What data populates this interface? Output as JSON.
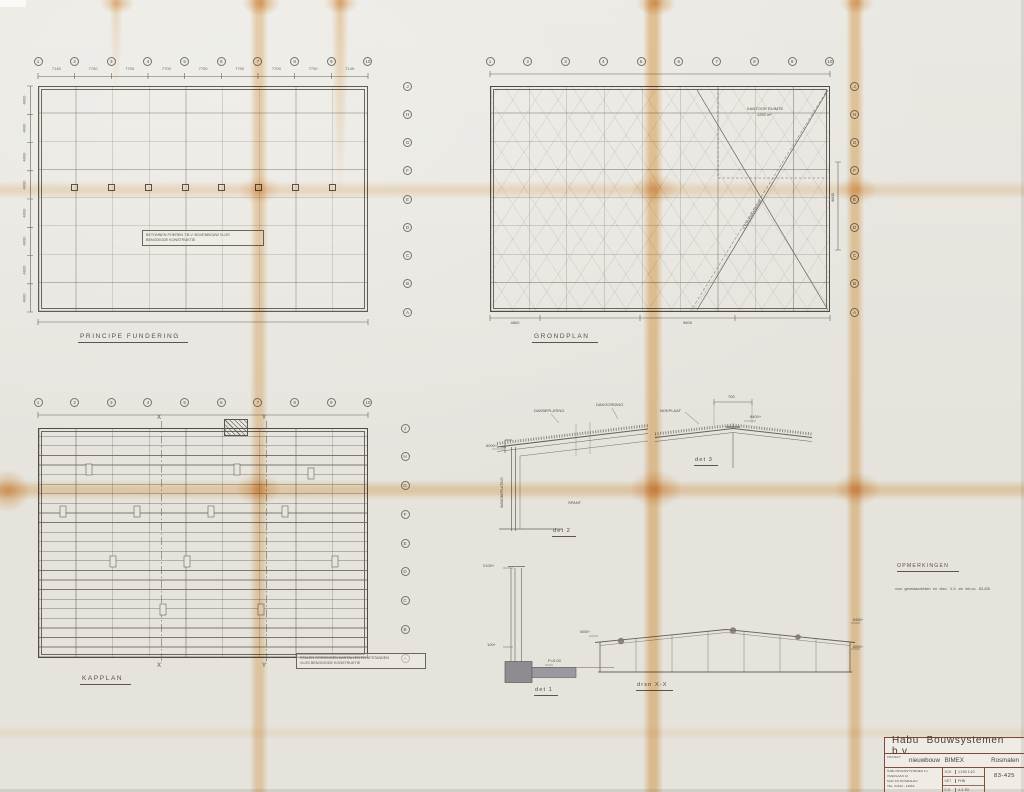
{
  "colors": {
    "paper": "#e7e5df",
    "line": "#66625b",
    "fold": "#ecba78",
    "titleblock_line": "#7c4c38"
  },
  "fundering": {
    "title": "PRINCIPE FUNDERING",
    "cols": [
      "1",
      "2",
      "3",
      "4",
      "5",
      "6",
      "7",
      "8",
      "9",
      "10"
    ],
    "rows": [
      "J",
      "H",
      "G",
      "F",
      "E",
      "D",
      "C",
      "B",
      "A"
    ],
    "top_dims": [
      "7145",
      "7700",
      "7700",
      "7700",
      "7700",
      "7700",
      "7700",
      "7700",
      "7145"
    ],
    "left_dims": [
      "4800",
      "4800",
      "4800",
      "4800",
      "4800",
      "4800",
      "4800",
      "4800"
    ],
    "note_line1": "BETONNEN POEREN T.B.V. BOVENBOUW VLGS",
    "note_line2": "BENODIGDE KONSTRUKTIE"
  },
  "grondplan": {
    "title": "GRONDPLAN",
    "cols": [
      "1",
      "2",
      "3",
      "4",
      "5",
      "6",
      "7",
      "8",
      "9",
      "10"
    ],
    "rows": [
      "J",
      "H",
      "G",
      "F",
      "E",
      "D",
      "C",
      "B",
      "A"
    ],
    "kantoor_line1": "KANTOOR RUIMTE",
    "kantoor_line2": "±250 m²",
    "kraan_label": "5 TON KRAANBAAN",
    "dim_right": "4800",
    "dim_bottom_left": "4800",
    "dim_bottom_mid": "9600"
  },
  "kapplan": {
    "title": "KAPPLAN",
    "cols": [
      "1",
      "2",
      "3",
      "4",
      "5",
      "6",
      "7",
      "8",
      "9",
      "10"
    ],
    "rows": [
      "J",
      "H",
      "G",
      "F",
      "E",
      "D",
      "C",
      "B",
      "A"
    ],
    "marker_x": "X",
    "marker_y": "Y",
    "note_line1": "STALEN GORDINGEN AANTALLEN EN AFSTANDEN",
    "note_line2": "VLGS BENODIGDE KONSTRUKTIE"
  },
  "det1": {
    "label": "det 1",
    "level_top": "2100+",
    "level_low": "100+",
    "peil": "P=0.00"
  },
  "det2": {
    "label": "det 2",
    "dakbeplating": "DAKBEPLATING",
    "dakgording": "DAKGORDING",
    "level": "6000+",
    "wand": "WANDBEPLATING",
    "spant": "SPANT"
  },
  "det3": {
    "label": "det 3",
    "nokplaat": "NOKPLAAT",
    "level": "8400+",
    "dim": "700"
  },
  "doorsnede": {
    "label": "drsn X-X",
    "level_left": "6000+",
    "level_right_top": "8400+",
    "level_right_low": "6000+"
  },
  "opmerkingen": {
    "title": "OPMERKINGEN",
    "note": "voor gevelaanzichten en drsn. X-X zie tek.no. 83-426"
  },
  "titleblock": {
    "company": "Habu  Bouwsystemen  b.v.",
    "project_label": "PROJECT",
    "project_name": "nieuwbouw  BIMEX",
    "project_city": "Rosmalen",
    "address1": "HABU BOUWSYSTEMEN b.v.",
    "address2": "OVERLAAN 12",
    "address3": "5242 PG ROSMALEN",
    "address4": "TEL. 04192 - 13963",
    "sch_k": "SCH.",
    "sch_v": "1:100  1:10",
    "get_k": "GET.",
    "get_v": "FHB",
    "dd_k": "D.D.",
    "dd_v": "4-3-'83",
    "number": "83-425"
  }
}
